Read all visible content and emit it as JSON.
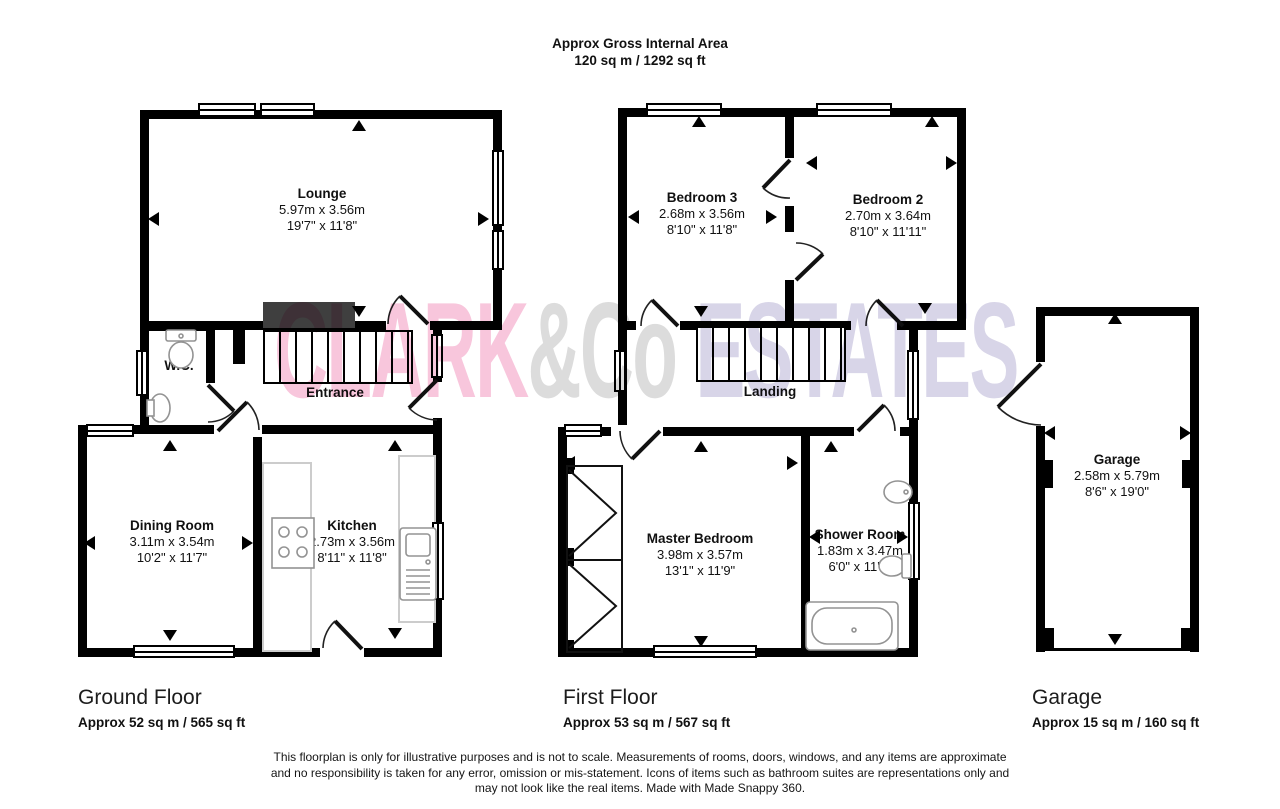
{
  "header": {
    "title": "Approx Gross Internal Area",
    "subtitle": "120 sq m / 1292 sq ft"
  },
  "watermark": {
    "part1": "CLARK",
    "part2": "&Co",
    "part3": " ESTATES",
    "color_part1": "#f8c6dc",
    "color_part2": "#dcdcdc",
    "color_part3": "#d8d5e8"
  },
  "rooms": {
    "lounge": {
      "name": "Lounge",
      "metric": "5.97m x 3.56m",
      "imperial": "19'7\" x 11'8\""
    },
    "wc": {
      "name": "W.C."
    },
    "entrance": {
      "name": "Entrance"
    },
    "dining": {
      "name": "Dining Room",
      "metric": "3.11m x 3.54m",
      "imperial": "10'2\" x 11'7\""
    },
    "kitchen": {
      "name": "Kitchen",
      "metric": "2.73m x 3.56m",
      "imperial": "8'11\" x 11'8\""
    },
    "bedroom3": {
      "name": "Bedroom 3",
      "metric": "2.68m x 3.56m",
      "imperial": "8'10\" x 11'8\""
    },
    "bedroom2": {
      "name": "Bedroom 2",
      "metric": "2.70m x 3.64m",
      "imperial": "8'10\" x 11'11\""
    },
    "landing": {
      "name": "Landing"
    },
    "master": {
      "name": "Master Bedroom",
      "metric": "3.98m x 3.57m",
      "imperial": "13'1\" x 11'9\""
    },
    "shower": {
      "name": "Shower Room",
      "metric": "1.83m x 3.47m",
      "imperial": "6'0\" x 11'5\""
    },
    "garage": {
      "name": "Garage",
      "metric": "2.58m x 5.79m",
      "imperial": "8'6\" x 19'0\""
    }
  },
  "floors": [
    {
      "label": "Ground Floor",
      "area": "Approx 52 sq m / 565 sq ft"
    },
    {
      "label": "First Floor",
      "area": "Approx 53 sq m / 567 sq ft"
    },
    {
      "label": "Garage",
      "area": "Approx 15 sq m / 160 sq ft"
    }
  ],
  "footer": {
    "lines": [
      "This floorplan is only for illustrative purposes and is not to scale. Measurements of rooms, doors, windows, and any items are approximate",
      "and no responsibility is taken for any error, omission or mis-statement. Icons of items such as bathroom suites are representations only and",
      "may not look like the real items. Made with Made Snappy 360."
    ]
  }
}
